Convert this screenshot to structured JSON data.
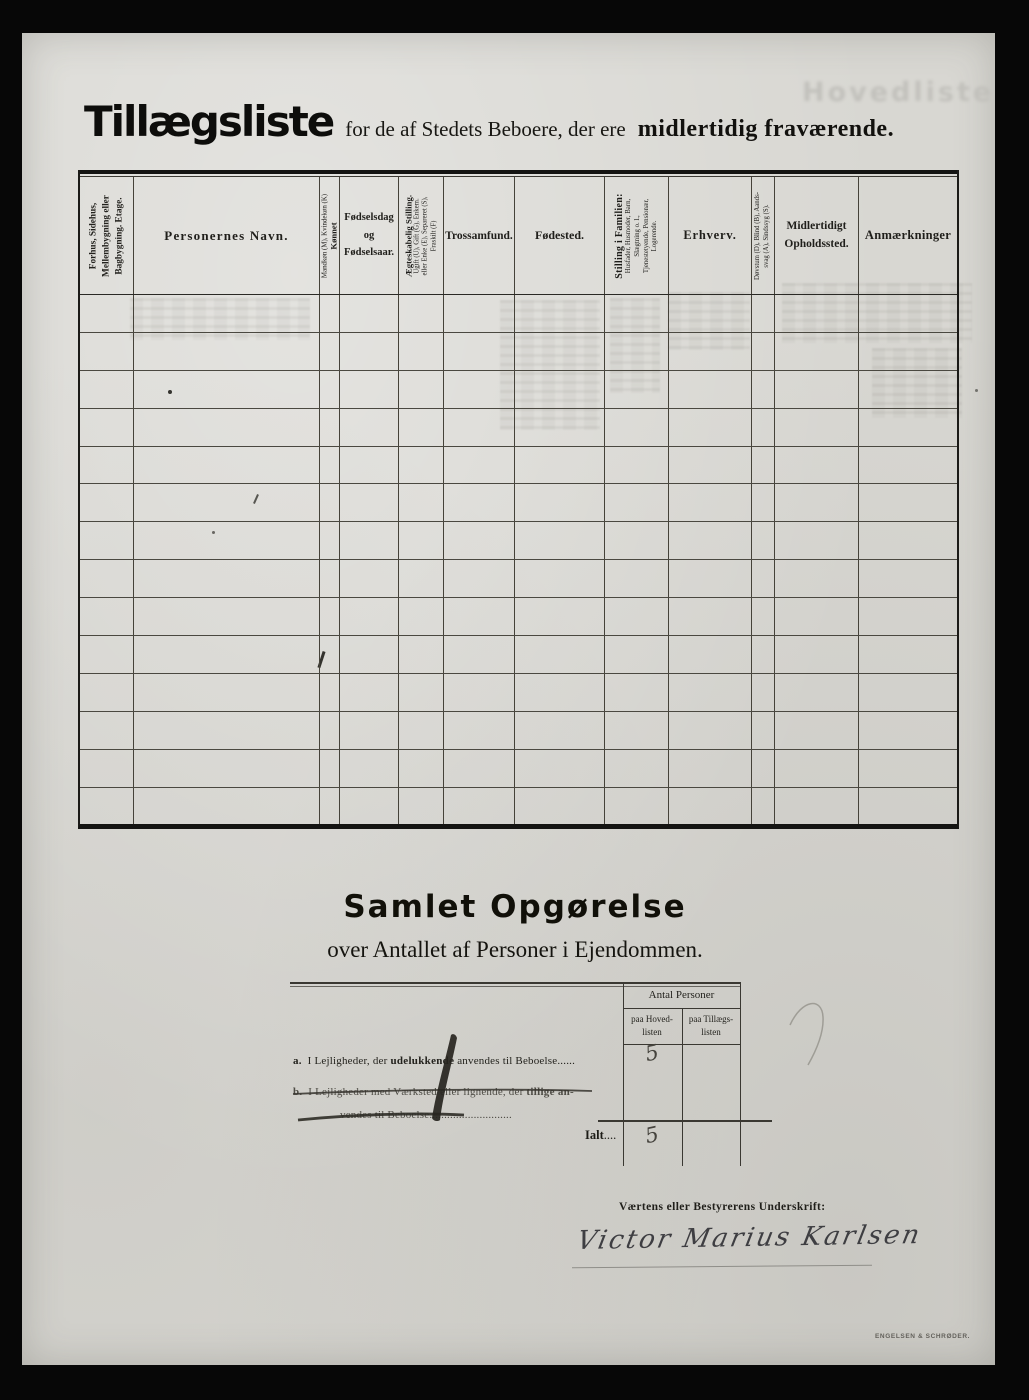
{
  "document": {
    "title_main": "Tillægsliste",
    "title_mid": "for de af Stedets Beboere, der ere",
    "title_emphasis": "midlertidig fraværende.",
    "ghost_bleedthrough": "Hovedliste",
    "printer_mark": "ENGELSEN & SCHRØDER."
  },
  "table": {
    "row_count": 14,
    "column_count": 12,
    "columns": [
      {
        "name": "building",
        "lines": [
          "Forhus, Sidehus,",
          "Mellembygning eller",
          "Bagbygning.   Etage."
        ]
      },
      {
        "name": "person-name",
        "label": "Personernes Navn."
      },
      {
        "name": "sex",
        "sub": "Mandkøn (M), Kvindekøn (K)",
        "main": "Kønnet"
      },
      {
        "name": "birth-date",
        "lines": [
          "Fødselsdag",
          "og",
          "Fødselsaar."
        ]
      },
      {
        "name": "marital-status",
        "main": "Ægteskabelig Stilling.",
        "subs": [
          "Ugift (U), Gift (G), Enkem.",
          "eller Enke (E), Separeret (S),",
          "Fraskilt (F)"
        ]
      },
      {
        "name": "faith",
        "label": "Trossamfund."
      },
      {
        "name": "birthplace",
        "label": "Fødested."
      },
      {
        "name": "family-position",
        "main": "Stilling i Familien:",
        "subs": [
          "Husfader, Husmoder, Barn,",
          "Slægtning o. l.,",
          "Tjenestetyende, Pensionær,",
          "Logerende."
        ]
      },
      {
        "name": "occupation",
        "label": "Erhverv."
      },
      {
        "name": "disability",
        "subs": [
          "Døvstum (D), Blind (B), Aands-",
          "svag (A), Sindssyg (S)."
        ]
      },
      {
        "name": "temporary-location",
        "lines": [
          "Midlertidigt",
          "Opholdssted."
        ]
      },
      {
        "name": "remarks",
        "label": "Anmærkninger"
      }
    ]
  },
  "summary": {
    "heading": "Samlet Opgørelse",
    "subheading": "over Antallet af Personer i Ejendommen.",
    "count_header": "Antal Personer",
    "col_main_line1": "paa Hoved-",
    "col_main_line2": "listen",
    "col_suppl_line1": "paa Tillægs-",
    "col_suppl_line2": "listen",
    "row_a": {
      "prefix": "a.",
      "text_start": "I Lejligheder, der ",
      "bold": "udelukkende",
      "text_end": " anvendes til Beboelse",
      "dots": "......",
      "value": "5"
    },
    "row_b": {
      "prefix": "b.",
      "line1_start": "I Lejligheder med Værksted eller lignende, der ",
      "line1_bold": "tillige an-",
      "line2": "vendes til Beboelse",
      "dots": "............................"
    },
    "total": {
      "label": "Ialt",
      "dots": "....",
      "value": "5"
    },
    "signature_label": "Værtens eller Bestyrerens Underskrift:",
    "signature": "Victor Marius Karlsen"
  }
}
